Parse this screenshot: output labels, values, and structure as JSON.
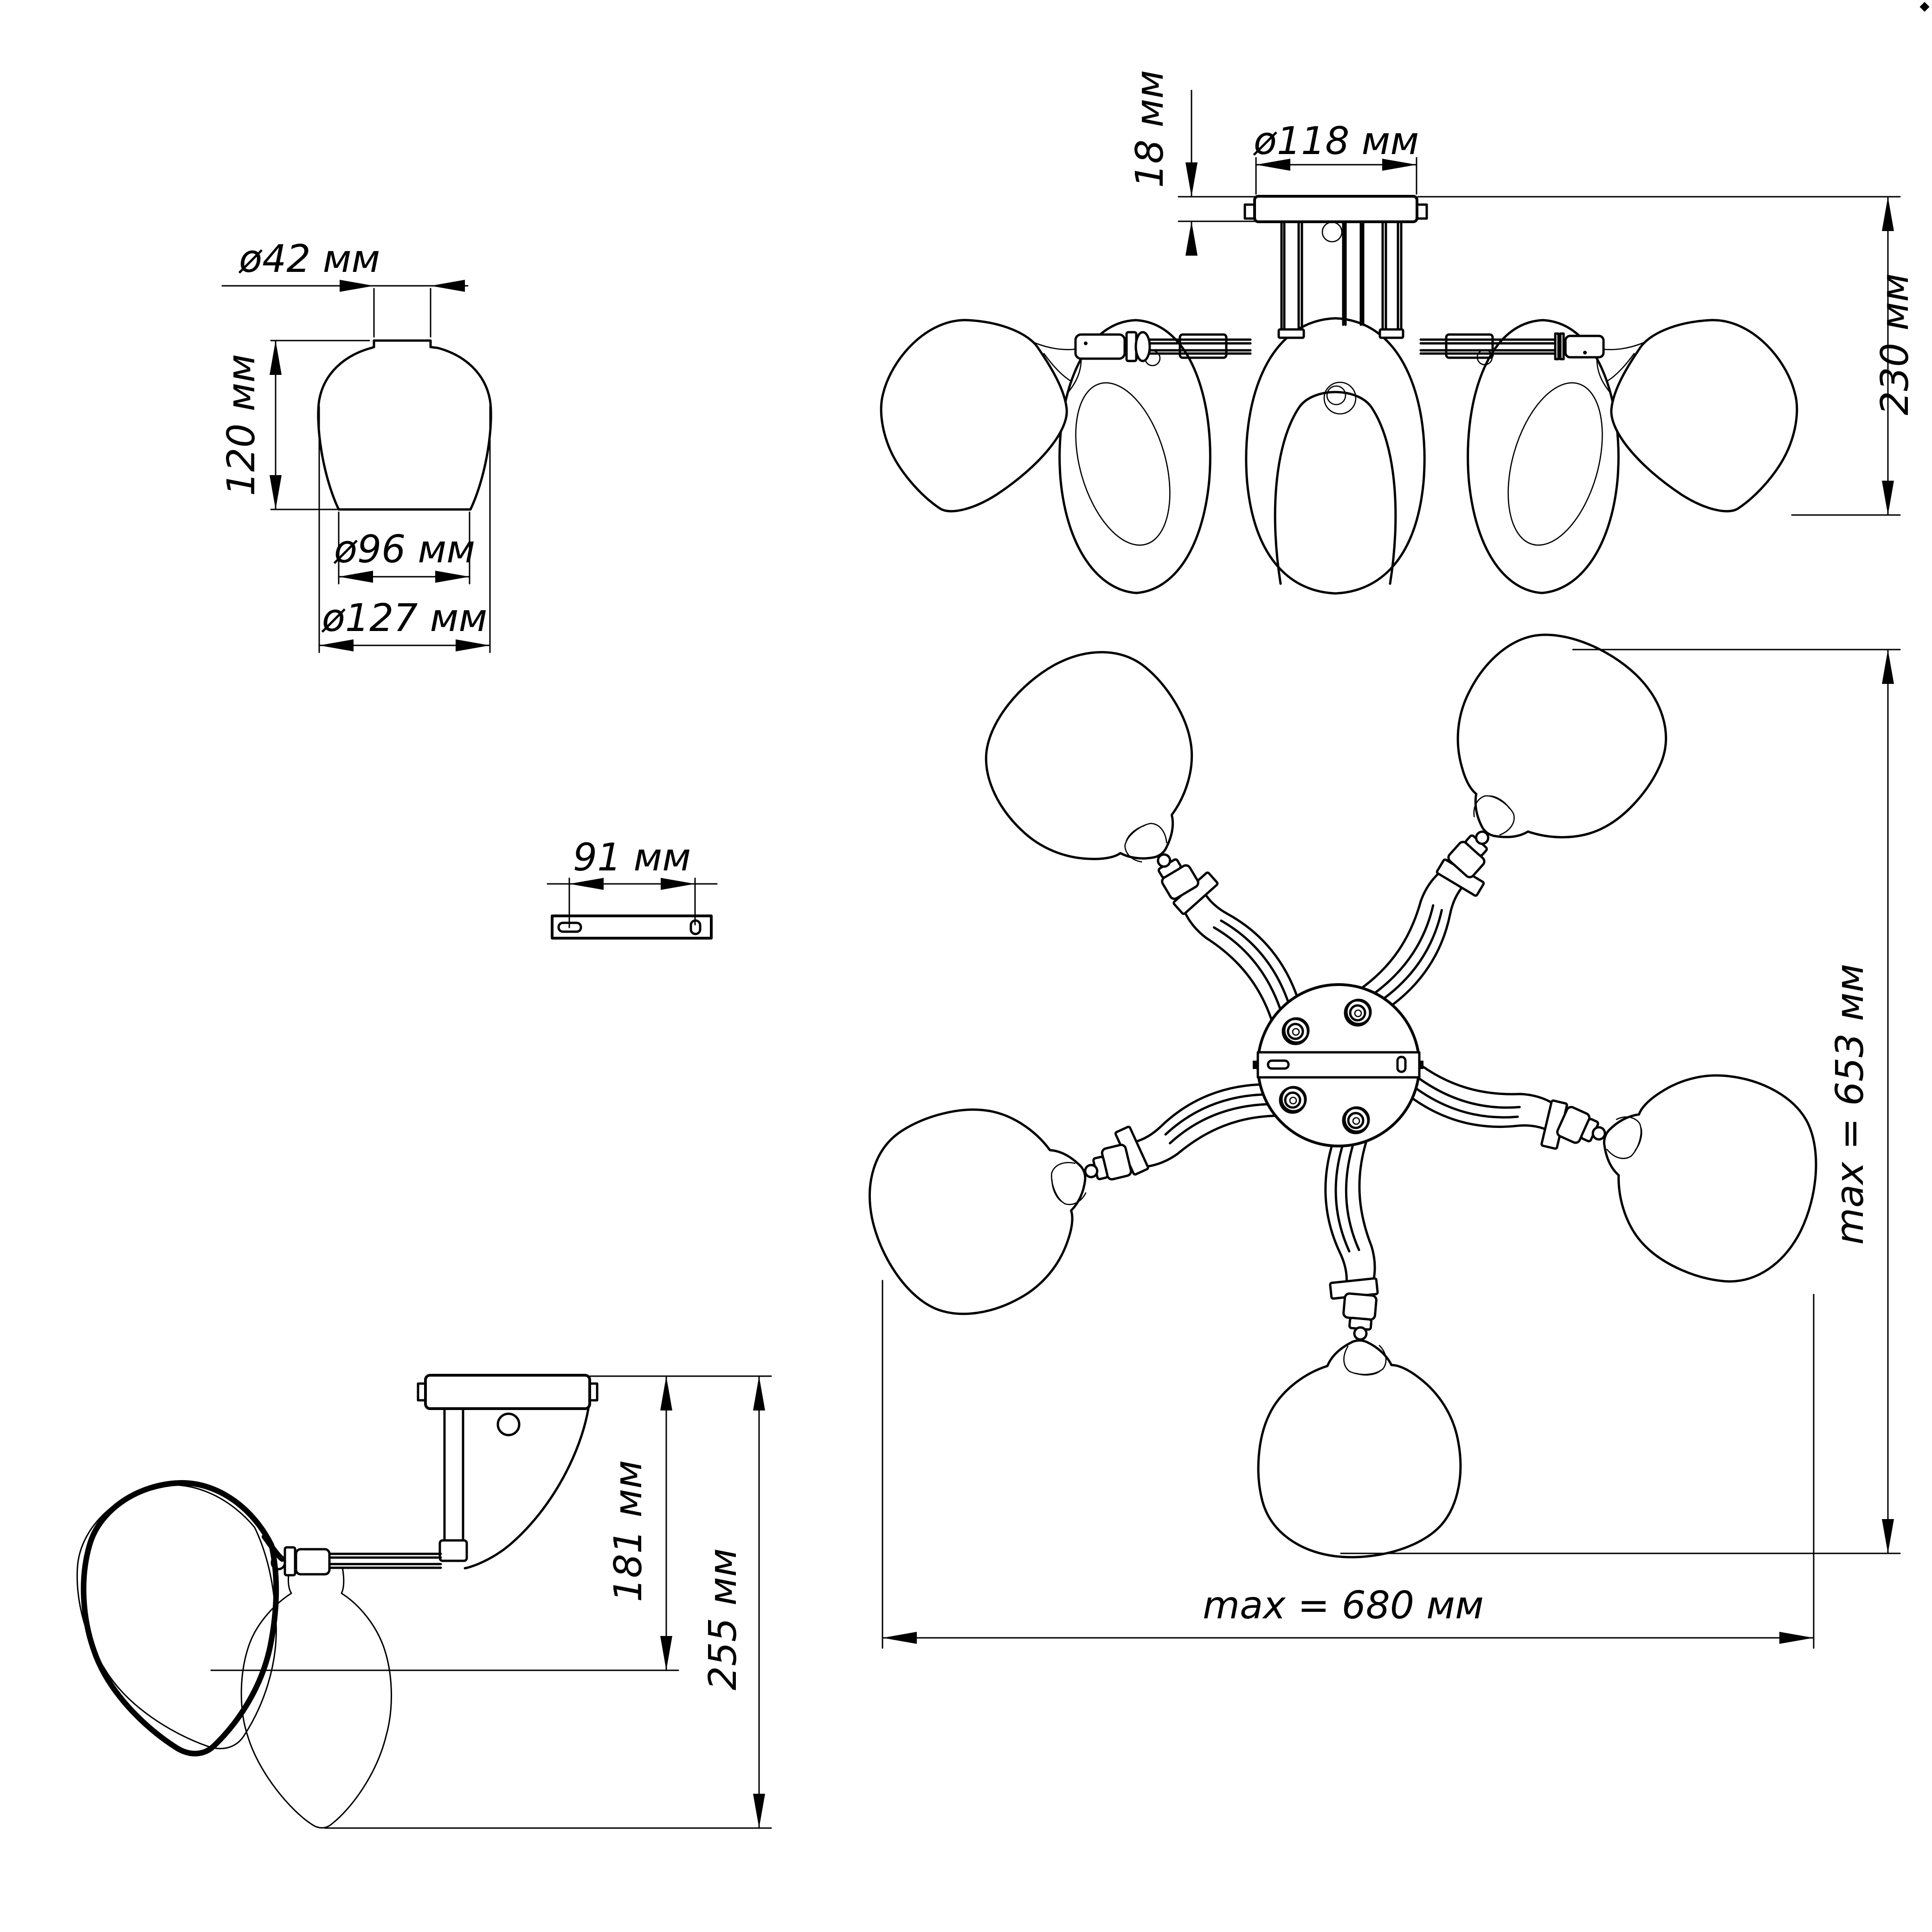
{
  "drawing": {
    "type": "technical-dimension-drawing",
    "subject": "5-arm ceiling chandelier",
    "colors": {
      "line": "#000000",
      "background": "#ffffff"
    },
    "views": {
      "shade_detail": {
        "top_diameter": "ø42 мм",
        "height": "120 мм",
        "opening_diameter": "ø96 мм",
        "max_diameter": "ø127 мм"
      },
      "front_view": {
        "canopy_height": "18 мм",
        "canopy_diameter": "ø118 мм",
        "fixture_height": "230 мм"
      },
      "bracket": {
        "hole_spacing": "91 мм"
      },
      "top_view": {
        "max_depth": "max = 653 мм",
        "max_width": "max = 680 мм"
      },
      "side_view": {
        "arm_height": "181 мм",
        "max_height": "255 мм"
      }
    }
  }
}
